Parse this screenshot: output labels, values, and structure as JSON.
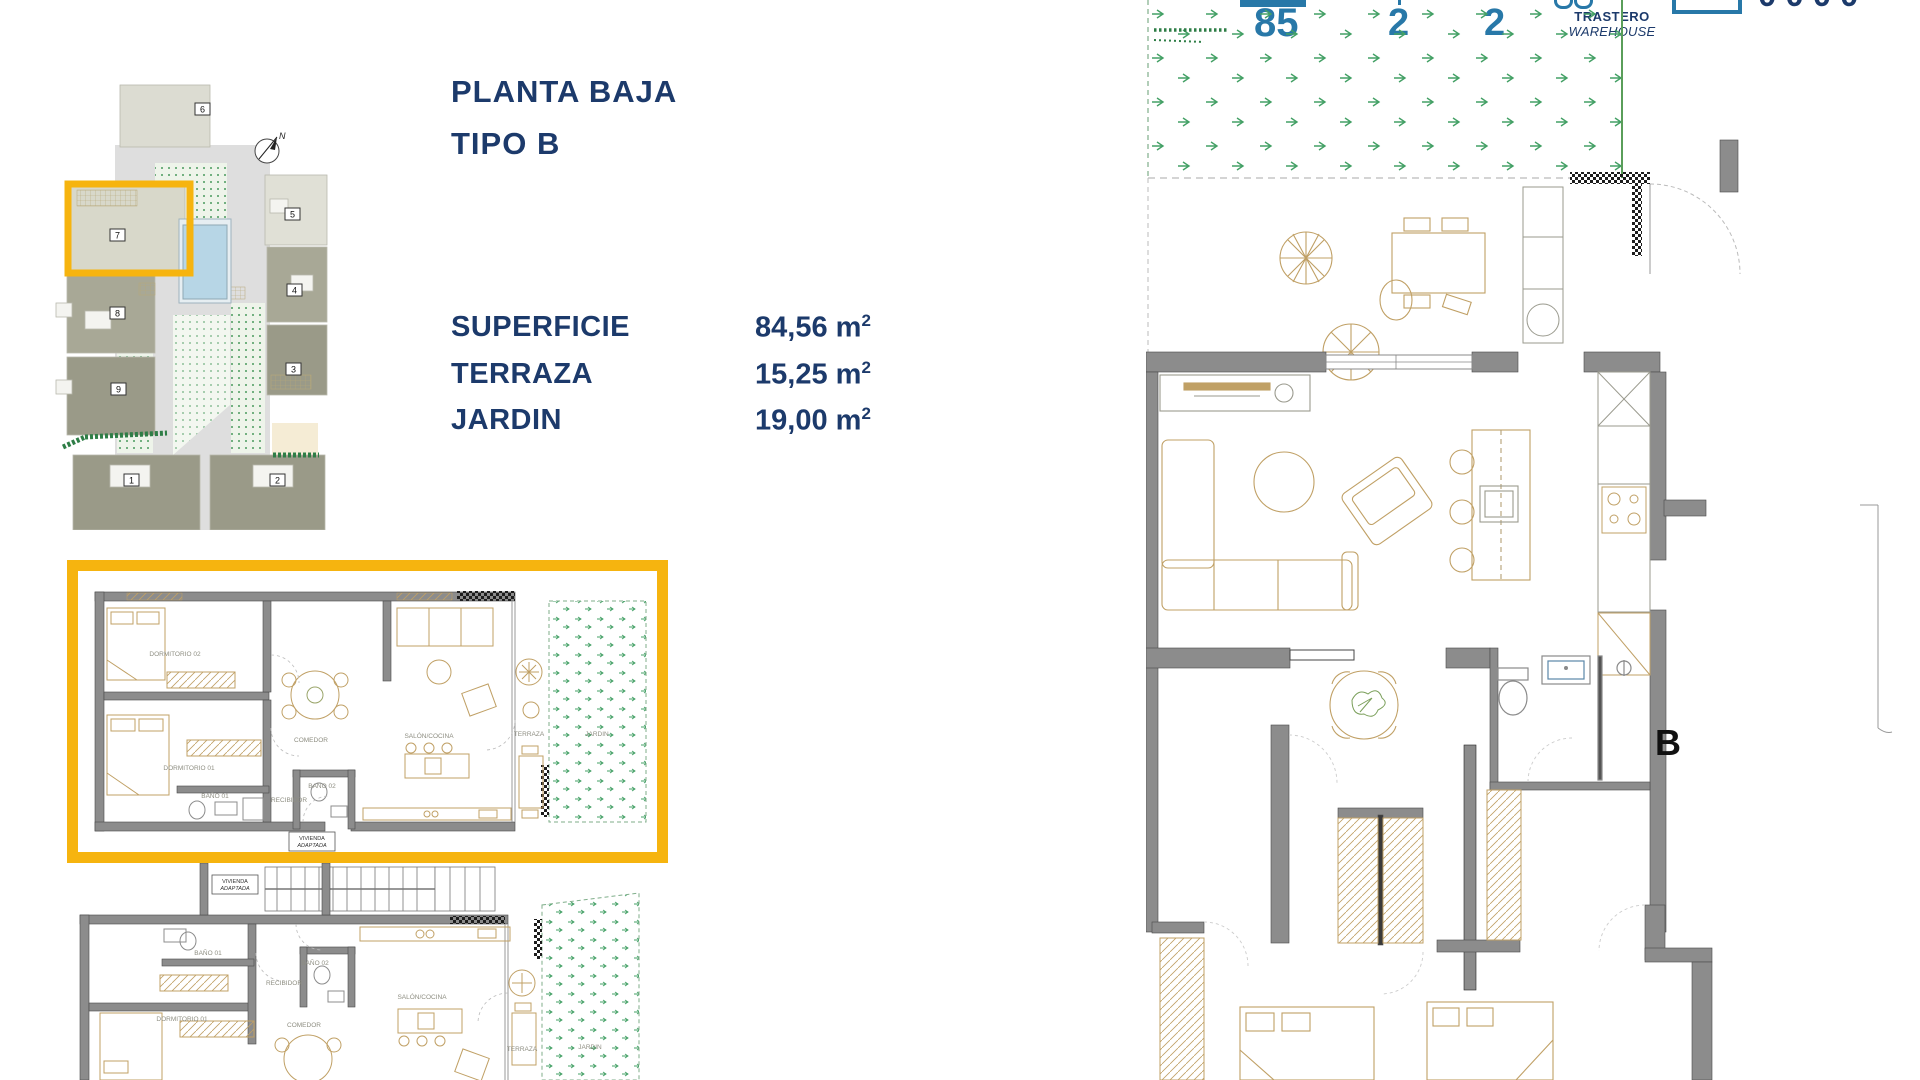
{
  "colors": {
    "navy": "#1c3a6b",
    "teal": "#2878a8",
    "highlight_yellow": "#f6b40f",
    "wall_gray": "#8c8c8c",
    "furniture_tan": "#c0a065",
    "plant_green": "#3f9e63",
    "label_gray": "#8e8e82"
  },
  "title": {
    "line1": "PLANTA BAJA",
    "line2": "TIPO B"
  },
  "specs": [
    {
      "label": "SUPERFICIE",
      "value": "84,56",
      "unit": "m",
      "sup": "2"
    },
    {
      "label": "TERRAZA",
      "value": "15,25",
      "unit": "m",
      "sup": "2"
    },
    {
      "label": "JARDIN",
      "value": "19,00",
      "unit": "m",
      "sup": "2"
    }
  ],
  "site_plan": {
    "compass": "N",
    "highlighted_unit": "7",
    "labels": {
      "u1": "1",
      "u2": "2",
      "u3": "3",
      "u4": "4",
      "u5": "5",
      "u6": "6",
      "u7": "7",
      "u8": "8",
      "u9": "9"
    }
  },
  "header": {
    "area": "85",
    "bedrooms": "2",
    "bathrooms": "2",
    "storage_line1": "TRASTERO",
    "storage_line2": "WAREHOUSE",
    "cut_glyphs": "0000"
  },
  "plan_b": {
    "letter": "B"
  },
  "rooms": {
    "dorm2": "DORMITORIO 02",
    "dorm1": "DORMITORIO 01",
    "bano1": "BAÑO 01",
    "bano2": "BAÑO 02",
    "recibidor": "RECIBIDOR",
    "comedor": "COMEDOR",
    "salon": "SALÓN/COCINA",
    "terraza": "TERRAZA",
    "jardin": "JARDIN",
    "vivienda_line1": "VIVIENDA",
    "vivienda_line2": "ADAPTADA"
  }
}
